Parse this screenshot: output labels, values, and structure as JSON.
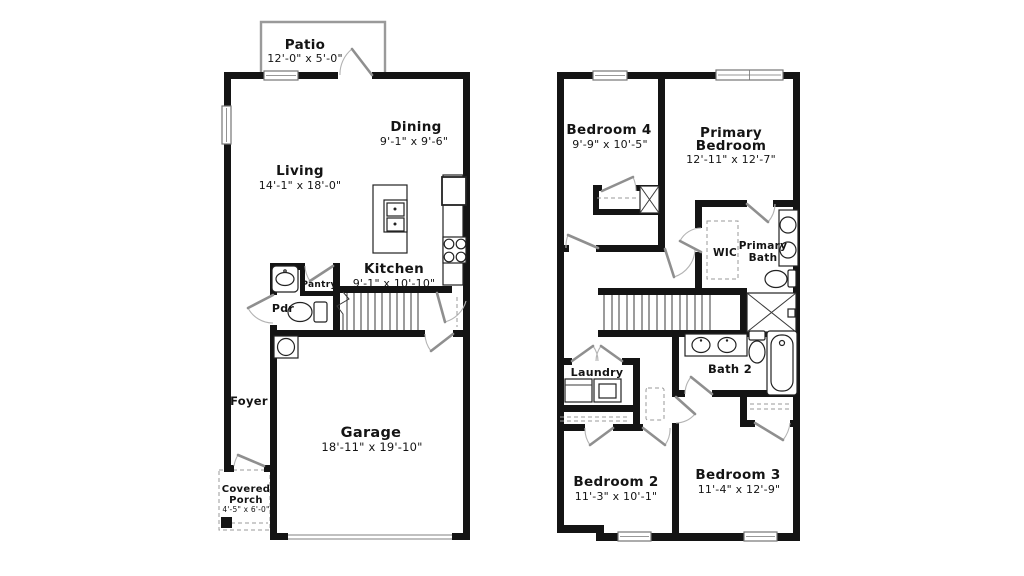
{
  "colors": {
    "wall": "#141414",
    "door_leaf": "#8f8f8f",
    "door_arc": "#b3b3b3",
    "window_stroke": "#767676",
    "dashed": "#9a9a9a",
    "background": "#ffffff",
    "text": "#141414"
  },
  "first_floor": {
    "patio": {
      "name": "Patio",
      "dims": "12'-0\" x 5'-0\""
    },
    "dining": {
      "name": "Dining",
      "dims": "9'-1\" x 9'-6\""
    },
    "living": {
      "name": "Living",
      "dims": "14'-1\" x 18'-0\""
    },
    "kitchen": {
      "name": "Kitchen",
      "dims": "9'-1\" x 10'-10\""
    },
    "pantry": {
      "name": "Pantry"
    },
    "powder_room": {
      "name": "Pdr"
    },
    "foyer": {
      "name": "Foyer"
    },
    "garage": {
      "name": "Garage",
      "dims": "18'-11\" x 19'-10\""
    },
    "covered_porch": {
      "name_line1": "Covered",
      "name_line2": "Porch",
      "dims": "4'-5\" x 6'-0\""
    }
  },
  "second_floor": {
    "bedroom4": {
      "name": "Bedroom 4",
      "dims": "9'-9\" x 10'-5\""
    },
    "primary_bedroom": {
      "name_line1": "Primary",
      "name_line2": "Bedroom",
      "dims": "12'-11\" x 12'-7\""
    },
    "wic": {
      "name": "WIC"
    },
    "primary_bath": {
      "name_line1": "Primary",
      "name_line2": "Bath"
    },
    "laundry": {
      "name": "Laundry"
    },
    "bath2": {
      "name": "Bath 2"
    },
    "bedroom2": {
      "name": "Bedroom 2",
      "dims": "11'-3\" x 10'-1\""
    },
    "bedroom3": {
      "name": "Bedroom 3",
      "dims": "11'-4\" x 12'-9\""
    }
  }
}
